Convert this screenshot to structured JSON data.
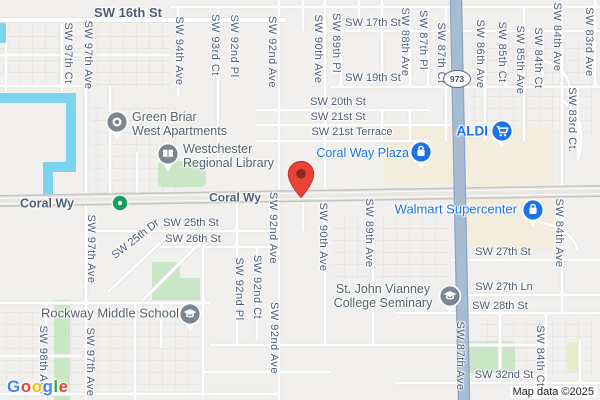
{
  "map": {
    "attribution": "Map data ©2025",
    "route_shield": {
      "label": "973",
      "x": 457,
      "y": 79
    },
    "destination_pin": {
      "x": 301,
      "y": 199
    },
    "logo_letters": [
      {
        "ch": "G",
        "color": "#4285F4"
      },
      {
        "ch": "o",
        "color": "#EA4335"
      },
      {
        "ch": "o",
        "color": "#FBBC05"
      },
      {
        "ch": "g",
        "color": "#4285F4"
      },
      {
        "ch": "l",
        "color": "#34A853"
      },
      {
        "ch": "e",
        "color": "#EA4335"
      }
    ],
    "colors": {
      "water": "#7dd4ee",
      "major_road": "#a7bcd3",
      "shopping_area": "#f3edde",
      "park": "#c9e7c6",
      "street_label": "#4d5d76",
      "poi_label": "#54626b",
      "shopping_label": "#1a73e8",
      "pin_red": "#EA4335",
      "pin_gray": "#7a8792",
      "pin_green": "#12a05c",
      "pin_blue": "#1a73e8"
    },
    "street_labels": [
      {
        "text": "SW 16th St",
        "x": 128,
        "y": 13,
        "size": 13,
        "weight": 700
      },
      {
        "text": "SW 17th St",
        "x": 373,
        "y": 24
      },
      {
        "text": "SW 19th St",
        "x": 373,
        "y": 79
      },
      {
        "text": "SW 20th St",
        "x": 338,
        "y": 103
      },
      {
        "text": "SW 21st St",
        "x": 338,
        "y": 118
      },
      {
        "text": "SW 21st Terrace",
        "x": 352,
        "y": 133
      },
      {
        "text": "Coral Wy",
        "x": 47,
        "y": 204,
        "size": 12.5,
        "weight": 700
      },
      {
        "text": "Coral Wy",
        "x": 235,
        "y": 198,
        "size": 12,
        "weight": 700
      },
      {
        "text": "SW 25th St",
        "x": 191,
        "y": 224
      },
      {
        "text": "SW 26th St",
        "x": 193,
        "y": 240
      },
      {
        "text": "SW 25th Dr",
        "x": 136,
        "y": 240,
        "angle": -38
      },
      {
        "text": "SW 27th St",
        "x": 503,
        "y": 253
      },
      {
        "text": "SW 27th Ln",
        "x": 504,
        "y": 288
      },
      {
        "text": "SW 28th St",
        "x": 500,
        "y": 307
      },
      {
        "text": "SW 32nd St",
        "x": 504,
        "y": 376
      },
      {
        "text": "SW 97th Ct",
        "x": 67,
        "y": 53,
        "vertical": true
      },
      {
        "text": "SW 97th Ave",
        "x": 87,
        "y": 55,
        "vertical": true
      },
      {
        "text": "SW 94th Ave",
        "x": 178,
        "y": 51,
        "vertical": true
      },
      {
        "text": "SW 93rd Ct",
        "x": 214,
        "y": 45,
        "vertical": true
      },
      {
        "text": "SW 92nd Pl",
        "x": 233,
        "y": 46,
        "vertical": true
      },
      {
        "text": "SW 92nd Ave",
        "x": 271,
        "y": 52,
        "vertical": true
      },
      {
        "text": "SW 90th Ave",
        "x": 317,
        "y": 49,
        "vertical": true
      },
      {
        "text": "SW 89th Pl",
        "x": 335,
        "y": 43,
        "vertical": true
      },
      {
        "text": "SW 88th Ave",
        "x": 404,
        "y": 42,
        "vertical": true
      },
      {
        "text": "SW 87th Pl",
        "x": 422,
        "y": 40,
        "vertical": true
      },
      {
        "text": "SW 87th Ct",
        "x": 440,
        "y": 53,
        "vertical": true
      },
      {
        "text": "SW 86th Ave",
        "x": 479,
        "y": 54,
        "vertical": true
      },
      {
        "text": "SW 85th Ct",
        "x": 501,
        "y": 52,
        "vertical": true
      },
      {
        "text": "SW 85th Ave",
        "x": 519,
        "y": 60,
        "vertical": true
      },
      {
        "text": "SW 84th Ct",
        "x": 537,
        "y": 58,
        "vertical": true
      },
      {
        "text": "SW 84th Ave",
        "x": 556,
        "y": 37,
        "vertical": true
      },
      {
        "text": "SW 83rd Ave",
        "x": 588,
        "y": 42,
        "vertical": true
      },
      {
        "text": "SW 83rd Ct.",
        "x": 571,
        "y": 120,
        "vertical": true
      },
      {
        "text": "SW 97th Ave",
        "x": 90,
        "y": 249,
        "vertical": true
      },
      {
        "text": "SW 92nd Ave",
        "x": 272,
        "y": 228,
        "vertical": true
      },
      {
        "text": "SW 90th Ave",
        "x": 322,
        "y": 237,
        "vertical": true
      },
      {
        "text": "SW 89th Ave",
        "x": 368,
        "y": 233,
        "vertical": true
      },
      {
        "text": "SW 84th Ave",
        "x": 558,
        "y": 233,
        "vertical": true
      },
      {
        "text": "SW 92nd Pl",
        "x": 238,
        "y": 289,
        "vertical": true
      },
      {
        "text": "SW 92nd Ct",
        "x": 256,
        "y": 287,
        "vertical": true
      },
      {
        "text": "SW 92nd Ave",
        "x": 273,
        "y": 338,
        "vertical": true
      },
      {
        "text": "SW 98th Ave",
        "x": 42,
        "y": 360,
        "vertical": true
      },
      {
        "text": "SW 97th Ave",
        "x": 89,
        "y": 362,
        "vertical": true
      },
      {
        "text": "SW 87th Ave",
        "x": 459,
        "y": 356,
        "vertical": true
      },
      {
        "text": "SW 84th Ct",
        "x": 539,
        "y": 356,
        "vertical": true
      }
    ],
    "pois": [
      {
        "id": "green-briar-west-apartments",
        "icon": "ring",
        "pin": "gray",
        "x": 117,
        "y": 122,
        "label": {
          "lines": [
            "Green Briar",
            "West Apartments"
          ],
          "x": 132,
          "y": 124,
          "align": "left",
          "type": "poi",
          "size": 12.5
        }
      },
      {
        "id": "westchester-regional-library",
        "icon": "book",
        "pin": "gray",
        "x": 168,
        "y": 154,
        "label": {
          "lines": [
            "Westchester",
            "Regional Library"
          ],
          "x": 183,
          "y": 156,
          "align": "left",
          "type": "poi",
          "size": 12.5
        }
      },
      {
        "id": "rockway-middle-school",
        "icon": "grad",
        "pin": "gray",
        "x": 190,
        "y": 314,
        "label": {
          "lines": [
            "Rockway Middle School"
          ],
          "x": 179,
          "y": 314,
          "align": "right",
          "type": "poi",
          "size": 13
        }
      },
      {
        "id": "st-john-vianney-college-seminary",
        "icon": "grad",
        "pin": "gray",
        "x": 450,
        "y": 296,
        "label": {
          "lines": [
            "St. John Vianney",
            "College Seminary"
          ],
          "x": 383,
          "y": 296,
          "align": "center",
          "type": "poi",
          "size": 12.5
        }
      },
      {
        "id": "coral-way-plaza",
        "icon": "bag",
        "pin": "blue",
        "x": 421,
        "y": 152,
        "label": {
          "lines": [
            "Coral Way Plaza"
          ],
          "x": 409,
          "y": 153,
          "align": "right",
          "type": "shop",
          "size": 12.5
        }
      },
      {
        "id": "aldi",
        "icon": "cart",
        "pin": "blue",
        "x": 502,
        "y": 131,
        "label": {
          "lines": [
            "ALDI"
          ],
          "x": 488,
          "y": 131,
          "align": "right",
          "type": "shop",
          "size": 13.5,
          "weight": 700
        }
      },
      {
        "id": "walmart-supercenter",
        "icon": "bag",
        "pin": "blue",
        "x": 533,
        "y": 210,
        "label": {
          "lines": [
            "Walmart Supercenter"
          ],
          "x": 517,
          "y": 210,
          "align": "right",
          "type": "shop",
          "size": 13
        }
      },
      {
        "id": "park-poi",
        "icon": "dot",
        "pin": "green",
        "x": 120,
        "y": 203,
        "small": true
      }
    ]
  }
}
